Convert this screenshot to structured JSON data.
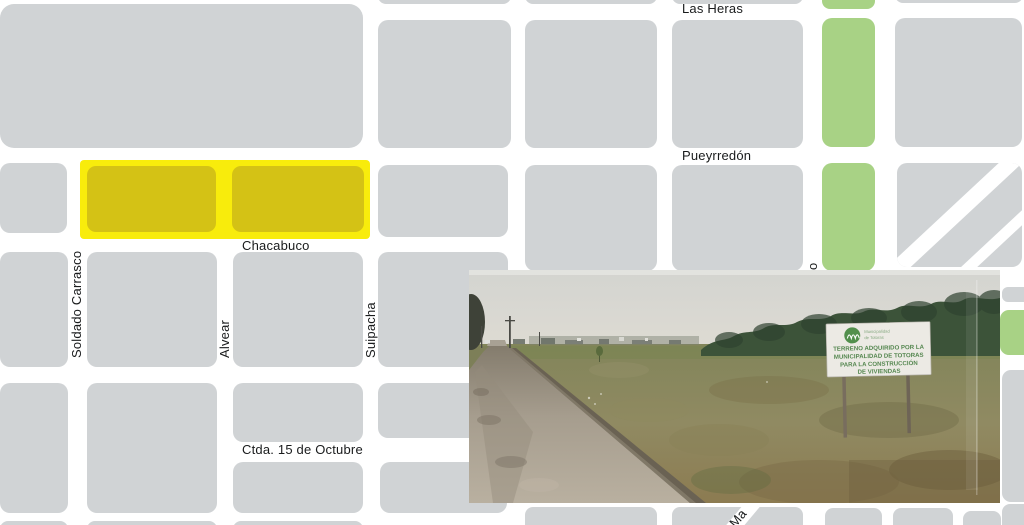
{
  "map": {
    "streets": {
      "las_heras": "Las Heras",
      "pueyrredon": "Pueyrredón",
      "chacabuco": "Chacabuco",
      "soldado_carrasco": "Soldado Carrasco",
      "alvear": "Alvear",
      "suipacha": "Suipacha",
      "ctda_15_de_octubre": "Ctda. 15 de Octubre",
      "partial_vertical_o": "o",
      "partial_diagonal_ma": "Ma"
    },
    "colors": {
      "bg": "#ffffff",
      "block": "#d0d3d5",
      "green": "#a8d285",
      "hl": "#f8ec0c",
      "hlb": "#d4c215",
      "label": "#191b1c"
    },
    "blocks": [
      {
        "x": 0,
        "y": 4,
        "w": 363,
        "h": 144,
        "r": 14,
        "name": "large-block-northwest"
      },
      {
        "x": 378,
        "y": -14,
        "w": 133,
        "h": 18,
        "r": 8
      },
      {
        "x": 525,
        "y": -14,
        "w": 132,
        "h": 18,
        "r": 8
      },
      {
        "x": 672,
        "y": -14,
        "w": 131,
        "h": 18,
        "r": 8
      },
      {
        "x": 822,
        "y": -14,
        "w": 53,
        "h": 23,
        "r": 8,
        "t": "green",
        "name": "green-block"
      },
      {
        "x": 895,
        "y": -14,
        "w": 128,
        "h": 17,
        "r": 8
      },
      {
        "x": 378,
        "y": 20,
        "w": 133,
        "h": 128
      },
      {
        "x": 525,
        "y": 20,
        "w": 132,
        "h": 128
      },
      {
        "x": 672,
        "y": 20,
        "w": 131,
        "h": 128
      },
      {
        "x": 822,
        "y": 18,
        "w": 53,
        "h": 129,
        "t": "green",
        "name": "green-block"
      },
      {
        "x": 895,
        "y": 18,
        "w": 127,
        "h": 129
      },
      {
        "x": 0,
        "y": 163,
        "w": 67,
        "h": 70
      },
      {
        "x": 80,
        "y": 160,
        "w": 290,
        "h": 79,
        "r": 4,
        "t": "hl",
        "name": "highlight-overlay"
      },
      {
        "x": 87,
        "y": 166,
        "w": 129,
        "h": 66,
        "r": 9,
        "t": "hlb",
        "name": "highlighted-block-1"
      },
      {
        "x": 232,
        "y": 166,
        "w": 132,
        "h": 66,
        "r": 9,
        "t": "hlb",
        "name": "highlighted-block-2"
      },
      {
        "x": 378,
        "y": 165,
        "w": 130,
        "h": 72
      },
      {
        "x": 525,
        "y": 165,
        "w": 132,
        "h": 106
      },
      {
        "x": 672,
        "y": 165,
        "w": 131,
        "h": 106
      },
      {
        "x": 822,
        "y": 163,
        "w": 53,
        "h": 108,
        "t": "green",
        "name": "green-block"
      },
      {
        "x": 0,
        "y": 252,
        "w": 68,
        "h": 115
      },
      {
        "x": 87,
        "y": 252,
        "w": 130,
        "h": 115
      },
      {
        "x": 233,
        "y": 252,
        "w": 130,
        "h": 115
      },
      {
        "x": 378,
        "y": 252,
        "w": 130,
        "h": 115
      },
      {
        "x": 0,
        "y": 383,
        "w": 68,
        "h": 130
      },
      {
        "x": 87,
        "y": 383,
        "w": 130,
        "h": 130
      },
      {
        "x": 233,
        "y": 383,
        "w": 130,
        "h": 59
      },
      {
        "x": 233,
        "y": 462,
        "w": 130,
        "h": 51
      },
      {
        "x": 378,
        "y": 383,
        "w": 130,
        "h": 55
      },
      {
        "x": 380,
        "y": 462,
        "w": 127,
        "h": 51
      },
      {
        "x": 0,
        "y": 521,
        "w": 68,
        "h": 30,
        "r": 8
      },
      {
        "x": 87,
        "y": 521,
        "w": 130,
        "h": 30,
        "r": 8
      },
      {
        "x": 233,
        "y": 521,
        "w": 130,
        "h": 30,
        "r": 8
      },
      {
        "x": 525,
        "y": 507,
        "w": 132,
        "h": 40,
        "r": 8
      },
      {
        "x": 825,
        "y": 508,
        "w": 57,
        "h": 40,
        "r": 8
      },
      {
        "x": 893,
        "y": 508,
        "w": 60,
        "h": 40,
        "r": 8
      },
      {
        "x": 963,
        "y": 511,
        "w": 38,
        "h": 40,
        "r": 8
      },
      {
        "x": 1002,
        "y": 504,
        "w": 32,
        "h": 40,
        "r": 8
      },
      {
        "x": 1002,
        "y": 287,
        "w": 32,
        "h": 15,
        "r": 6
      },
      {
        "x": 1000,
        "y": 310,
        "w": 34,
        "h": 45,
        "r": 9,
        "t": "green",
        "name": "green-block"
      },
      {
        "x": 1002,
        "y": 370,
        "w": 32,
        "h": 132,
        "r": 9
      }
    ]
  },
  "photo": {
    "description": "street-view-of-vacant-lot",
    "sign": {
      "org_line1": "Municipalidad",
      "org_line2": "de Totoras",
      "line1": "TERRENO ADQUIRIDO POR LA",
      "line2": "MUNICIPALIDAD DE TOTORAS",
      "line3": "PARA LA CONSTRUCCIÓN",
      "line4": "DE VIVIENDAS"
    }
  }
}
